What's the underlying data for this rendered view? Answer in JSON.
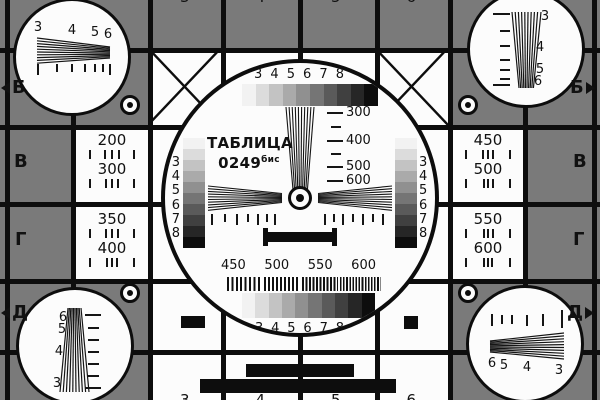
{
  "card": {
    "title": {
      "line1": "ТАБЛИЦА",
      "line2": "0249",
      "sup": "бис"
    },
    "colors": {
      "background_gray": "#7a7a7a",
      "line_black": "#0d0d0d",
      "white": "#fcfcfc"
    },
    "grayscale_steps": [
      "#f2f2f2",
      "#dcdcdc",
      "#c3c3c3",
      "#aaaaaa",
      "#909090",
      "#757575",
      "#5a5a5a",
      "#404040",
      "#262626",
      "#0d0d0d"
    ],
    "center": {
      "top_numbers": [
        "3",
        "4",
        "5",
        "6",
        "7",
        "8"
      ],
      "bottom_numbers": [
        "3",
        "4",
        "5",
        "6",
        "7",
        "8"
      ],
      "left_strip_numbers": [
        "3",
        "4",
        "5",
        "6",
        "7",
        "8"
      ],
      "right_strip_numbers": [
        "3",
        "4",
        "5",
        "6",
        "7",
        "8"
      ],
      "freq_labels": [
        "300",
        "400",
        "500",
        "600"
      ],
      "burst_labels": [
        "450",
        "500",
        "550",
        "600"
      ]
    },
    "cells": {
      "left": [
        {
          "a": "200",
          "b": "300"
        },
        {
          "a": "350",
          "b": "400"
        }
      ],
      "right": [
        {
          "a": "450",
          "b": "500"
        },
        {
          "a": "550",
          "b": "600"
        }
      ]
    },
    "corners": {
      "top_left": [
        "3",
        "4",
        "5",
        "6"
      ],
      "top_right": [
        "3",
        "4",
        "5",
        "6"
      ],
      "bottom_left": [
        "6",
        "5",
        "4",
        "3"
      ],
      "bottom_right": [
        "6",
        "5",
        "4",
        "3"
      ]
    },
    "edge": {
      "top_digits": [
        "3",
        "4",
        "5",
        "6"
      ],
      "bottom_digits": [
        "3",
        "4",
        "5",
        "6"
      ],
      "left": {
        "b": "Б",
        "v": "В",
        "g": "Г",
        "d": "Д"
      },
      "right": {
        "b": "Б",
        "v": "В",
        "g": "Г",
        "d": "Д"
      }
    }
  }
}
